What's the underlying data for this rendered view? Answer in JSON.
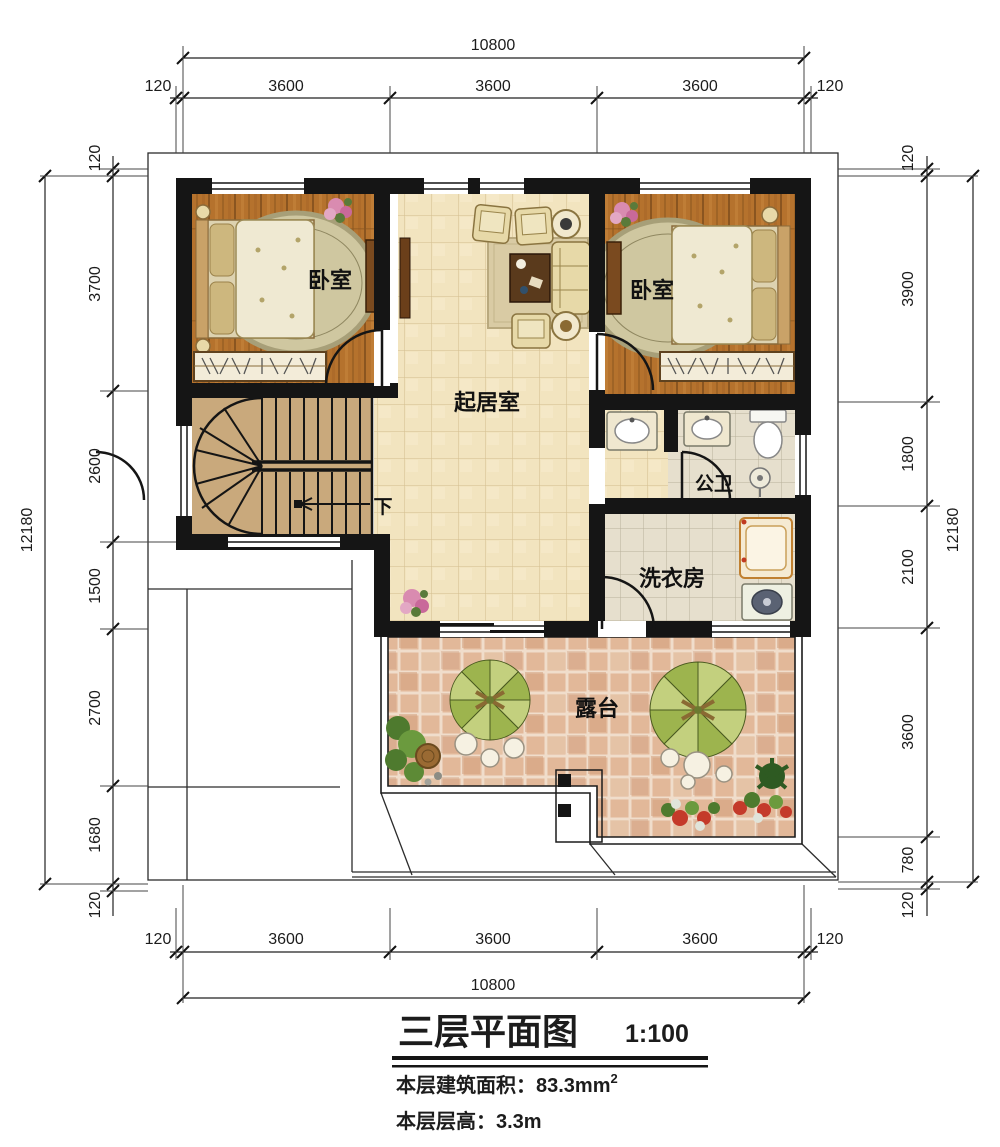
{
  "title": {
    "main": "三层平面图",
    "scale": "1:100",
    "area_label": "本层建筑面积：83.3mm",
    "area_sup": "2",
    "height_line": "本层层高：3.3m"
  },
  "rooms": {
    "bedroom_left": "卧室",
    "bedroom_right": "卧室",
    "living_room": "起居室",
    "bathroom": "公卫",
    "laundry": "洗衣房",
    "terrace": "露台",
    "stairs_down": "下"
  },
  "dims": {
    "top": {
      "overall": "10800",
      "segments": [
        "120",
        "3600",
        "3600",
        "3600",
        "120"
      ]
    },
    "bottom": {
      "overall": "10800",
      "segments": [
        "120",
        "3600",
        "3600",
        "3600",
        "120"
      ]
    },
    "left": {
      "overall": "12180",
      "segments": [
        "120",
        "3700",
        "2600",
        "1500",
        "2700",
        "1680",
        "120"
      ]
    },
    "right": {
      "overall": "12180",
      "segments": [
        "120",
        "3900",
        "1800",
        "2100",
        "3600",
        "780",
        "120"
      ]
    }
  },
  "colors": {
    "wall": "#151515",
    "wood_floor": "#b5722d",
    "living_tile": "#f2e4bf",
    "bath_tile": "#e6dfcd",
    "terrace_tile": "#e2b899",
    "stair": "#c9a97c",
    "umbrella_green": "#9db44e"
  }
}
